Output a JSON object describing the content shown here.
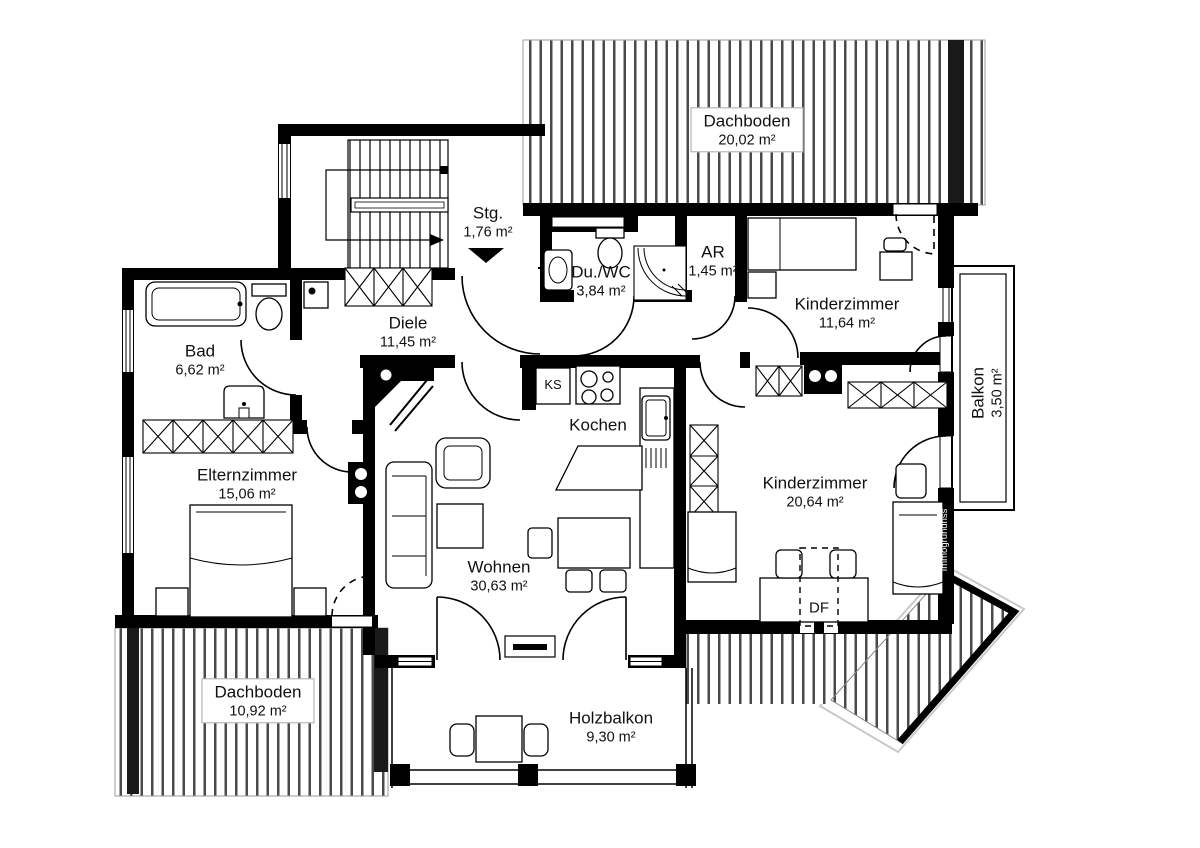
{
  "watermark": "Immogrundriss",
  "rooms": {
    "dachboden_top": {
      "name": "Dachboden",
      "area": "20,02 m²"
    },
    "stg": {
      "name": "Stg.",
      "area": "1,76 m²"
    },
    "du_wc": {
      "name": "Du./WC",
      "area": "3,84 m²"
    },
    "ar": {
      "name": "AR",
      "area": "1,45 m²"
    },
    "kinderzimmer_1": {
      "name": "Kinderzimmer",
      "area": "11,64 m²"
    },
    "balkon": {
      "name": "Balkon",
      "area": "3,50 m²"
    },
    "bad": {
      "name": "Bad",
      "area": "6,62 m²"
    },
    "diele": {
      "name": "Diele",
      "area": "11,45 m²"
    },
    "elternzimmer": {
      "name": "Elternzimmer",
      "area": "15,06 m²"
    },
    "kochen": {
      "name": "Kochen",
      "area": ""
    },
    "wohnen": {
      "name": "Wohnen",
      "area": "30,63 m²"
    },
    "kinderzimmer_2": {
      "name": "Kinderzimmer",
      "area": "20,64 m²"
    },
    "dachboden_bottom": {
      "name": "Dachboden",
      "area": "10,92 m²"
    },
    "holzbalkon": {
      "name": "Holzbalkon",
      "area": "9,30 m²"
    }
  },
  "markers": {
    "ks": "KS",
    "df": "DF"
  },
  "colors": {
    "wall": "#000000",
    "background": "#ffffff",
    "stripe": "#4a4a4a"
  }
}
